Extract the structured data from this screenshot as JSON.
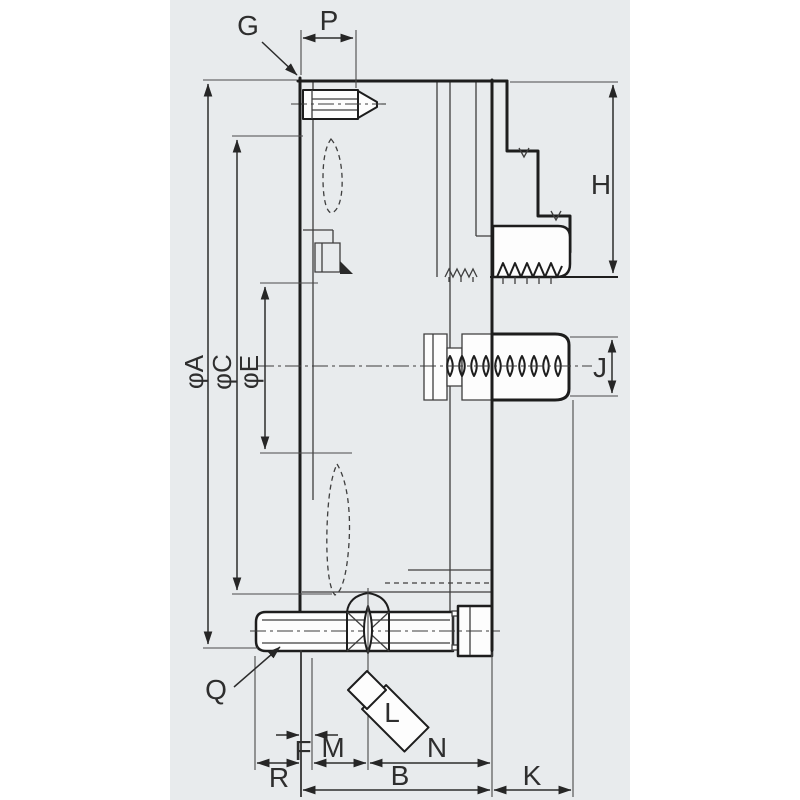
{
  "diagram": {
    "title": "lathe-chuck-cross-section",
    "labels": {
      "g": "G",
      "p": "P",
      "h": "H",
      "j": "J",
      "k": "K",
      "l": "L",
      "n": "N",
      "m": "M",
      "f": "F",
      "r": "R",
      "b": "B",
      "q": "Q",
      "phi_a": "φA",
      "phi_c": "φC",
      "phi_e": "φE"
    },
    "colors": {
      "panel_bg": "#e8ebed",
      "page_bg": "#ffffff",
      "outline": "#1d1d1d",
      "dimension": "#2c2c2c",
      "label_text": "#2e2e2e",
      "fill_white": "#fdfdfd"
    }
  }
}
